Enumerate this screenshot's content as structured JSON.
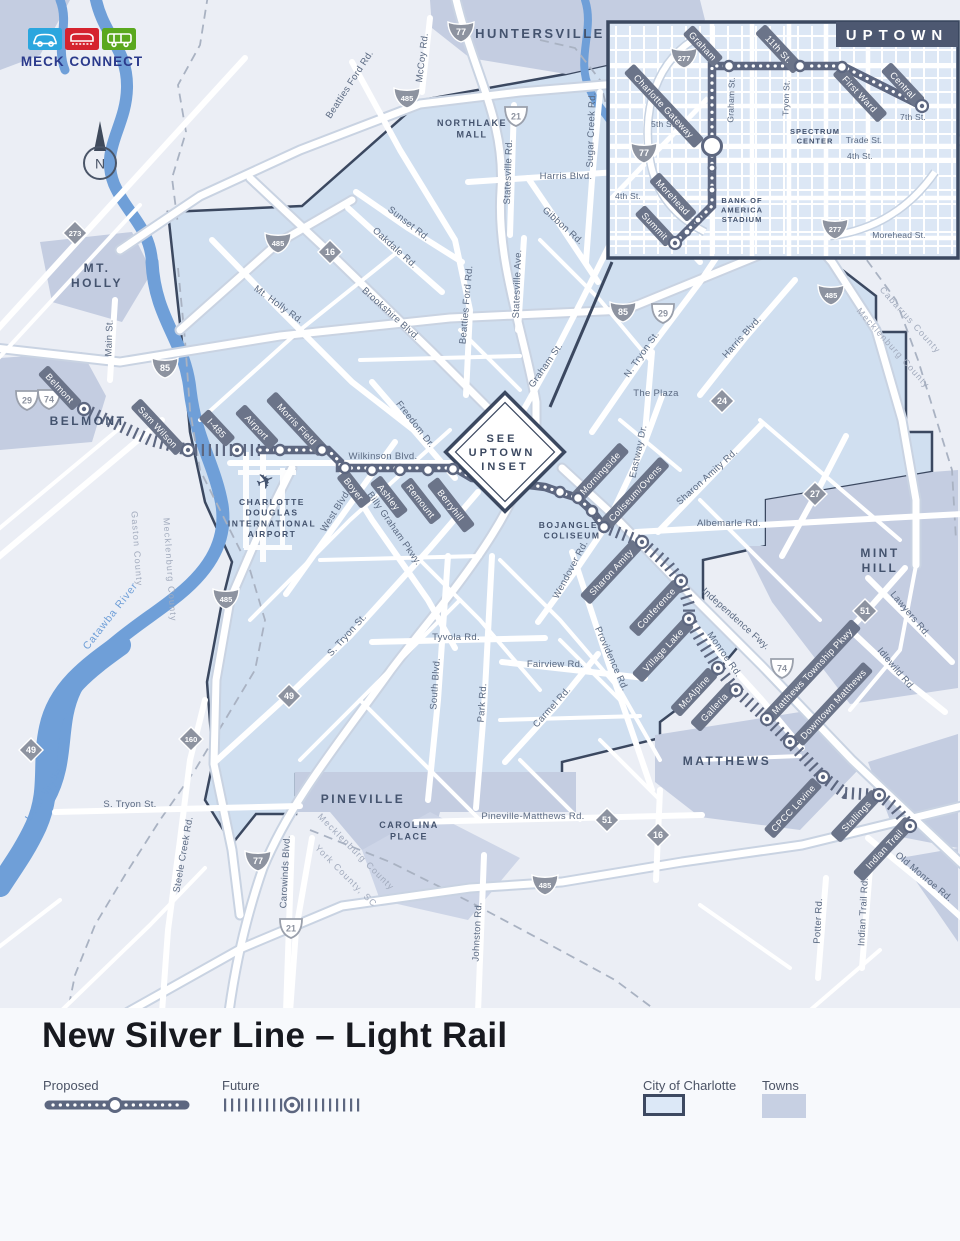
{
  "logo": {
    "brand": "MECK CONNECT",
    "icons": [
      "car-icon",
      "train-icon",
      "bus-icon"
    ],
    "colors": {
      "car_box": "#2ba6de",
      "train_box": "#d5232e",
      "bus_box": "#5aa81e",
      "brand_text": "#2b3a8c"
    }
  },
  "compass": {
    "label": "N"
  },
  "title": "New Silver Line – Light Rail",
  "legend": {
    "proposed": "Proposed",
    "future": "Future",
    "city": "City of Charlotte",
    "towns": "Towns"
  },
  "colors": {
    "city_fill": "#d0dff0",
    "town_fill": "#c4cde1",
    "route": "#5d6780",
    "pill": "#6b7489",
    "water": "#6f9fd8",
    "border": "#3b4860",
    "road_label": "#5b6a82",
    "county_label": "#a2abbd"
  },
  "inset": {
    "title": "UPTOWN",
    "shields": [
      {
        "n": "277",
        "t": "i",
        "x": 684,
        "y": 57
      },
      {
        "n": "77",
        "t": "i",
        "x": 644,
        "y": 152
      },
      {
        "n": "277",
        "t": "i",
        "x": 835,
        "y": 228
      }
    ],
    "streets": [
      {
        "t": "Graham St.",
        "x": 734,
        "y": 100,
        "r": -88
      },
      {
        "t": "Tryon St.",
        "x": 789,
        "y": 98,
        "r": -88
      },
      {
        "t": "5th St.",
        "x": 664,
        "y": 127,
        "r": 0
      },
      {
        "t": "7th St.",
        "x": 913,
        "y": 120,
        "r": 0
      },
      {
        "t": "Trade St.",
        "x": 864,
        "y": 143,
        "r": 0
      },
      {
        "t": "4th St.",
        "x": 860,
        "y": 159,
        "r": 0
      },
      {
        "t": "4th St.",
        "x": 628,
        "y": 199,
        "r": 0
      },
      {
        "t": "Morehead St.",
        "x": 899,
        "y": 238,
        "r": 0
      }
    ],
    "places": [
      {
        "lines": [
          "SPECTRUM",
          "CENTER"
        ],
        "x": 815,
        "y": 134
      },
      {
        "lines": [
          "BANK OF",
          "AMERICA",
          "STADIUM"
        ],
        "x": 742,
        "y": 203
      }
    ],
    "pills": [
      {
        "t": "Graham",
        "x": 703,
        "y": 46,
        "r": 47
      },
      {
        "t": "11th St.",
        "x": 779,
        "y": 49,
        "r": 47
      },
      {
        "t": "First Ward",
        "x": 860,
        "y": 94,
        "r": 47
      },
      {
        "t": "Central",
        "x": 903,
        "y": 85,
        "r": 47
      },
      {
        "t": "Charlotte Gateway",
        "x": 664,
        "y": 106,
        "r": 47
      },
      {
        "t": "Morehead",
        "x": 673,
        "y": 197,
        "r": 47
      },
      {
        "t": "Summit",
        "x": 655,
        "y": 226,
        "r": 47
      }
    ],
    "route_path": "M675,243 L712,206 L712,66 L842,66 L922,106",
    "stations": {
      "small": [
        [
          687,
          232
        ],
        [
          698,
          220
        ],
        [
          712,
          190
        ],
        [
          712,
          168
        ]
      ],
      "regular": [
        [
          729,
          66
        ],
        [
          800,
          66
        ],
        [
          842,
          67
        ]
      ],
      "hub": [
        [
          712,
          146
        ]
      ],
      "terminus": [
        [
          675,
          243
        ],
        [
          922,
          106
        ]
      ]
    }
  },
  "map": {
    "see_inset": [
      "SEE",
      "UPTOWN",
      "INSET"
    ],
    "plane_icon": "✈",
    "towns": [
      {
        "lines": [
          "HUNTERSVILLE"
        ],
        "x": 540,
        "y": 38,
        "fs": 13
      },
      {
        "lines": [
          "MT.",
          "HOLLY"
        ],
        "x": 97,
        "y": 272,
        "fs": 12
      },
      {
        "lines": [
          "BELMONT"
        ],
        "x": 88,
        "y": 425,
        "fs": 12
      },
      {
        "lines": [
          "MINT",
          "HILL"
        ],
        "x": 880,
        "y": 557,
        "fs": 12
      },
      {
        "lines": [
          "MATTHEWS"
        ],
        "x": 727,
        "y": 765,
        "fs": 12
      },
      {
        "lines": [
          "PINEVILLE"
        ],
        "x": 363,
        "y": 803,
        "fs": 12
      }
    ],
    "places": [
      {
        "lines": [
          "NORTHLAKE",
          "MALL"
        ],
        "x": 472,
        "y": 126,
        "fs": 9
      },
      {
        "lines": [
          "CAROLINA",
          "PLACE"
        ],
        "x": 409,
        "y": 828,
        "fs": 9
      },
      {
        "lines": [
          "CHARLOTTE",
          "DOUGLAS",
          "INTERNATIONAL",
          "AIRPORT"
        ],
        "x": 272,
        "y": 505,
        "fs": 8.5
      },
      {
        "lines": [
          "BOJANGLES",
          "COLISEUM"
        ],
        "x": 572,
        "y": 528,
        "fs": 8.5
      }
    ],
    "roads": [
      {
        "t": "McCoy Rd.",
        "x": 425,
        "y": 58,
        "r": -83
      },
      {
        "t": "Beatties Ford Rd.",
        "x": 352,
        "y": 86,
        "r": -57
      },
      {
        "t": "Sugar Creek Rd.",
        "x": 594,
        "y": 130,
        "r": -88
      },
      {
        "t": "Statesville Rd.",
        "x": 511,
        "y": 172,
        "r": -88
      },
      {
        "t": "Harris Blvd.",
        "x": 566,
        "y": 179,
        "r": 0
      },
      {
        "t": "Sunset Rd.",
        "x": 407,
        "y": 226,
        "r": 38
      },
      {
        "t": "Oakdale Rd.",
        "x": 393,
        "y": 250,
        "r": 42
      },
      {
        "t": "Gibbon Rd.",
        "x": 561,
        "y": 228,
        "r": 42
      },
      {
        "t": "Statesville Ave.",
        "x": 520,
        "y": 284,
        "r": -88
      },
      {
        "t": "Beatties Ford Rd.",
        "x": 469,
        "y": 305,
        "r": -85
      },
      {
        "t": "Brookshire Blvd.",
        "x": 389,
        "y": 316,
        "r": 42
      },
      {
        "t": "Mt. Holly Rd.",
        "x": 277,
        "y": 307,
        "r": 36
      },
      {
        "t": "Main St.",
        "x": 112,
        "y": 338,
        "r": -88
      },
      {
        "t": "Graham St.",
        "x": 548,
        "y": 367,
        "r": -55
      },
      {
        "t": "N. Tryon St.",
        "x": 644,
        "y": 356,
        "r": -55
      },
      {
        "t": "Harris Blvd.",
        "x": 744,
        "y": 339,
        "r": -48
      },
      {
        "t": "The Plaza",
        "x": 656,
        "y": 396,
        "r": 0
      },
      {
        "t": "Eastway Dr.",
        "x": 641,
        "y": 452,
        "r": -78
      },
      {
        "t": "Freedom Dr.",
        "x": 413,
        "y": 426,
        "r": 52
      },
      {
        "t": "Wilkinson Blvd.",
        "x": 383,
        "y": 459,
        "r": 0
      },
      {
        "t": "West Blvd.",
        "x": 338,
        "y": 512,
        "r": -58
      },
      {
        "t": "Billy Graham Pkwy.",
        "x": 392,
        "y": 530,
        "r": 55
      },
      {
        "t": "Sharon Amity Rd.",
        "x": 709,
        "y": 479,
        "r": -42
      },
      {
        "t": "Albemarle Rd.",
        "x": 729,
        "y": 526,
        "r": 0
      },
      {
        "t": "Wendover Rd.",
        "x": 573,
        "y": 571,
        "r": -62
      },
      {
        "t": "Independence Fwy.",
        "x": 734,
        "y": 621,
        "r": 42
      },
      {
        "t": "Monroe Rd.",
        "x": 722,
        "y": 656,
        "r": 55
      },
      {
        "t": "Providence Rd.",
        "x": 609,
        "y": 660,
        "r": 66
      },
      {
        "t": "Fairview Rd.",
        "x": 555,
        "y": 667,
        "r": 0
      },
      {
        "t": "Tyvola Rd.",
        "x": 456,
        "y": 640,
        "r": 0
      },
      {
        "t": "South Blvd.",
        "x": 438,
        "y": 684,
        "r": -86
      },
      {
        "t": "Park Rd.",
        "x": 485,
        "y": 703,
        "r": -86
      },
      {
        "t": "Carmel Rd.",
        "x": 554,
        "y": 709,
        "r": -48
      },
      {
        "t": "S. Tryon St.",
        "x": 349,
        "y": 637,
        "r": -48
      },
      {
        "t": "Lawyers Rd.",
        "x": 908,
        "y": 616,
        "r": 50
      },
      {
        "t": "Idlewild Rd.",
        "x": 894,
        "y": 671,
        "r": 50
      },
      {
        "t": "Pineville-Matthews Rd.",
        "x": 533,
        "y": 819,
        "r": 0
      },
      {
        "t": "Johnston Rd.",
        "x": 480,
        "y": 932,
        "r": -87
      },
      {
        "t": "Carowinds Blvd.",
        "x": 288,
        "y": 872,
        "r": -87
      },
      {
        "t": "Steele Creek Rd.",
        "x": 186,
        "y": 855,
        "r": -80
      },
      {
        "t": "S. Tryon St.",
        "x": 130,
        "y": 807,
        "r": 0
      },
      {
        "t": "Old Monroe Rd.",
        "x": 922,
        "y": 879,
        "r": 40
      },
      {
        "t": "Indian Trail Rd.",
        "x": 866,
        "y": 912,
        "r": -87
      },
      {
        "t": "Potter Rd.",
        "x": 821,
        "y": 921,
        "r": -87
      }
    ],
    "water_labels": [
      {
        "t": "Catawba River",
        "x": 113,
        "y": 618,
        "r": -52
      },
      {
        "t": "Lake Wylie",
        "x": 47,
        "y": 796,
        "r": -57
      }
    ],
    "county_labels": [
      {
        "t": "Cabarrus County",
        "x": 908,
        "y": 322,
        "r": 48
      },
      {
        "t": "Mecklenburg County",
        "x": 891,
        "y": 350,
        "r": 48
      },
      {
        "t": "Gaston County",
        "x": 134,
        "y": 549,
        "r": 86
      },
      {
        "t": "Mecklenburg County",
        "x": 167,
        "y": 570,
        "r": 86
      },
      {
        "t": "Mecklenburg County",
        "x": 354,
        "y": 854,
        "r": 45
      },
      {
        "t": "York County, SC",
        "x": 344,
        "y": 878,
        "r": 45
      }
    ],
    "shields": [
      {
        "n": "77",
        "t": "i",
        "x": 461,
        "y": 31
      },
      {
        "n": "485",
        "t": "i",
        "x": 407,
        "y": 97
      },
      {
        "n": "485",
        "t": "i",
        "x": 278,
        "y": 242
      },
      {
        "n": "85",
        "t": "i",
        "x": 165,
        "y": 367
      },
      {
        "n": "85",
        "t": "i",
        "x": 623,
        "y": 311
      },
      {
        "n": "485",
        "t": "i",
        "x": 831,
        "y": 294
      },
      {
        "n": "485",
        "t": "i",
        "x": 226,
        "y": 598
      },
      {
        "n": "485",
        "t": "i",
        "x": 545,
        "y": 884
      },
      {
        "n": "77",
        "t": "i",
        "x": 258,
        "y": 860
      },
      {
        "n": "21",
        "t": "us",
        "x": 516,
        "y": 116
      },
      {
        "n": "29",
        "t": "us",
        "x": 27,
        "y": 400
      },
      {
        "n": "74",
        "t": "us",
        "x": 49,
        "y": 399
      },
      {
        "n": "29",
        "t": "us",
        "x": 663,
        "y": 313
      },
      {
        "n": "74",
        "t": "us",
        "x": 782,
        "y": 668
      },
      {
        "n": "21",
        "t": "us",
        "x": 291,
        "y": 928
      },
      {
        "n": "16",
        "t": "nc",
        "x": 330,
        "y": 252
      },
      {
        "n": "273",
        "t": "nc",
        "x": 75,
        "y": 233
      },
      {
        "n": "24",
        "t": "nc",
        "x": 722,
        "y": 401
      },
      {
        "n": "27",
        "t": "nc",
        "x": 815,
        "y": 494
      },
      {
        "n": "51",
        "t": "nc",
        "x": 865,
        "y": 611
      },
      {
        "n": "51",
        "t": "nc",
        "x": 607,
        "y": 820
      },
      {
        "n": "16",
        "t": "nc",
        "x": 658,
        "y": 835
      },
      {
        "n": "49",
        "t": "nc",
        "x": 31,
        "y": 750
      },
      {
        "n": "49",
        "t": "nc",
        "x": 289,
        "y": 696
      },
      {
        "n": "160",
        "t": "nc",
        "x": 191,
        "y": 739
      }
    ],
    "pills": [
      {
        "t": "Belmont",
        "x": 60,
        "y": 388,
        "r": 47
      },
      {
        "t": "Sam Wilson",
        "x": 158,
        "y": 427,
        "r": 47
      },
      {
        "t": "I-485",
        "x": 217,
        "y": 428,
        "r": 47
      },
      {
        "t": "Airport",
        "x": 257,
        "y": 427,
        "r": 47
      },
      {
        "t": "Morris Field",
        "x": 297,
        "y": 424,
        "r": 47
      },
      {
        "t": "Boyer",
        "x": 354,
        "y": 489,
        "r": 52
      },
      {
        "t": "Ashley",
        "x": 389,
        "y": 497,
        "r": 52
      },
      {
        "t": "Remount",
        "x": 421,
        "y": 501,
        "r": 52
      },
      {
        "t": "Berryhill",
        "x": 451,
        "y": 505,
        "r": 52
      },
      {
        "t": "Morningside",
        "x": 600,
        "y": 473,
        "r": -47
      },
      {
        "t": "Coliseum/Ovens",
        "x": 635,
        "y": 493,
        "r": -47
      },
      {
        "t": "Sharon Amity",
        "x": 611,
        "y": 572,
        "r": -47
      },
      {
        "t": "Conference",
        "x": 656,
        "y": 608,
        "r": -47
      },
      {
        "t": "Village Lake",
        "x": 663,
        "y": 650,
        "r": -47
      },
      {
        "t": "McAlpine",
        "x": 694,
        "y": 692,
        "r": -47
      },
      {
        "t": "Galleria",
        "x": 714,
        "y": 707,
        "r": -47
      },
      {
        "t": "Matthews Township Pkwy",
        "x": 812,
        "y": 671,
        "r": -47
      },
      {
        "t": "Downtown Matthews",
        "x": 833,
        "y": 704,
        "r": -47
      },
      {
        "t": "CPCC Levine",
        "x": 793,
        "y": 808,
        "r": -47
      },
      {
        "t": "Stallings",
        "x": 856,
        "y": 816,
        "r": -47
      },
      {
        "t": "Indian Trail",
        "x": 884,
        "y": 849,
        "r": -47
      }
    ],
    "routes": {
      "future_west": {
        "path": "M84,409 L150,440 L188,450 L260,450",
        "stations": [
          [
            84,
            409
          ],
          [
            188,
            450
          ],
          [
            237,
            450
          ]
        ]
      },
      "proposed": {
        "path": "M260,450 L328,450 L340,462 L340,468 L455,468 L472,478 L545,487 L562,493 L578,498 L592,511 L604,527",
        "stations": [
          [
            280,
            450
          ],
          [
            322,
            450
          ],
          [
            345,
            468
          ],
          [
            372,
            470
          ],
          [
            400,
            470
          ],
          [
            428,
            470
          ],
          [
            453,
            469
          ],
          [
            560,
            492
          ],
          [
            578,
            498
          ],
          [
            592,
            511
          ],
          [
            604,
            527
          ]
        ]
      },
      "future_east": {
        "path": "M604,527 L642,542 L668,565 L681,581 L689,605 L689,619 L702,642 L718,668 L736,690 L767,719 L790,742 L823,777 L845,793 L879,795 L893,806 L910,826",
        "stations": [
          [
            642,
            542
          ],
          [
            681,
            581
          ],
          [
            689,
            619
          ],
          [
            718,
            668
          ],
          [
            736,
            690
          ],
          [
            767,
            719
          ],
          [
            790,
            742
          ],
          [
            823,
            777
          ],
          [
            879,
            795
          ],
          [
            910,
            826
          ]
        ]
      }
    }
  }
}
